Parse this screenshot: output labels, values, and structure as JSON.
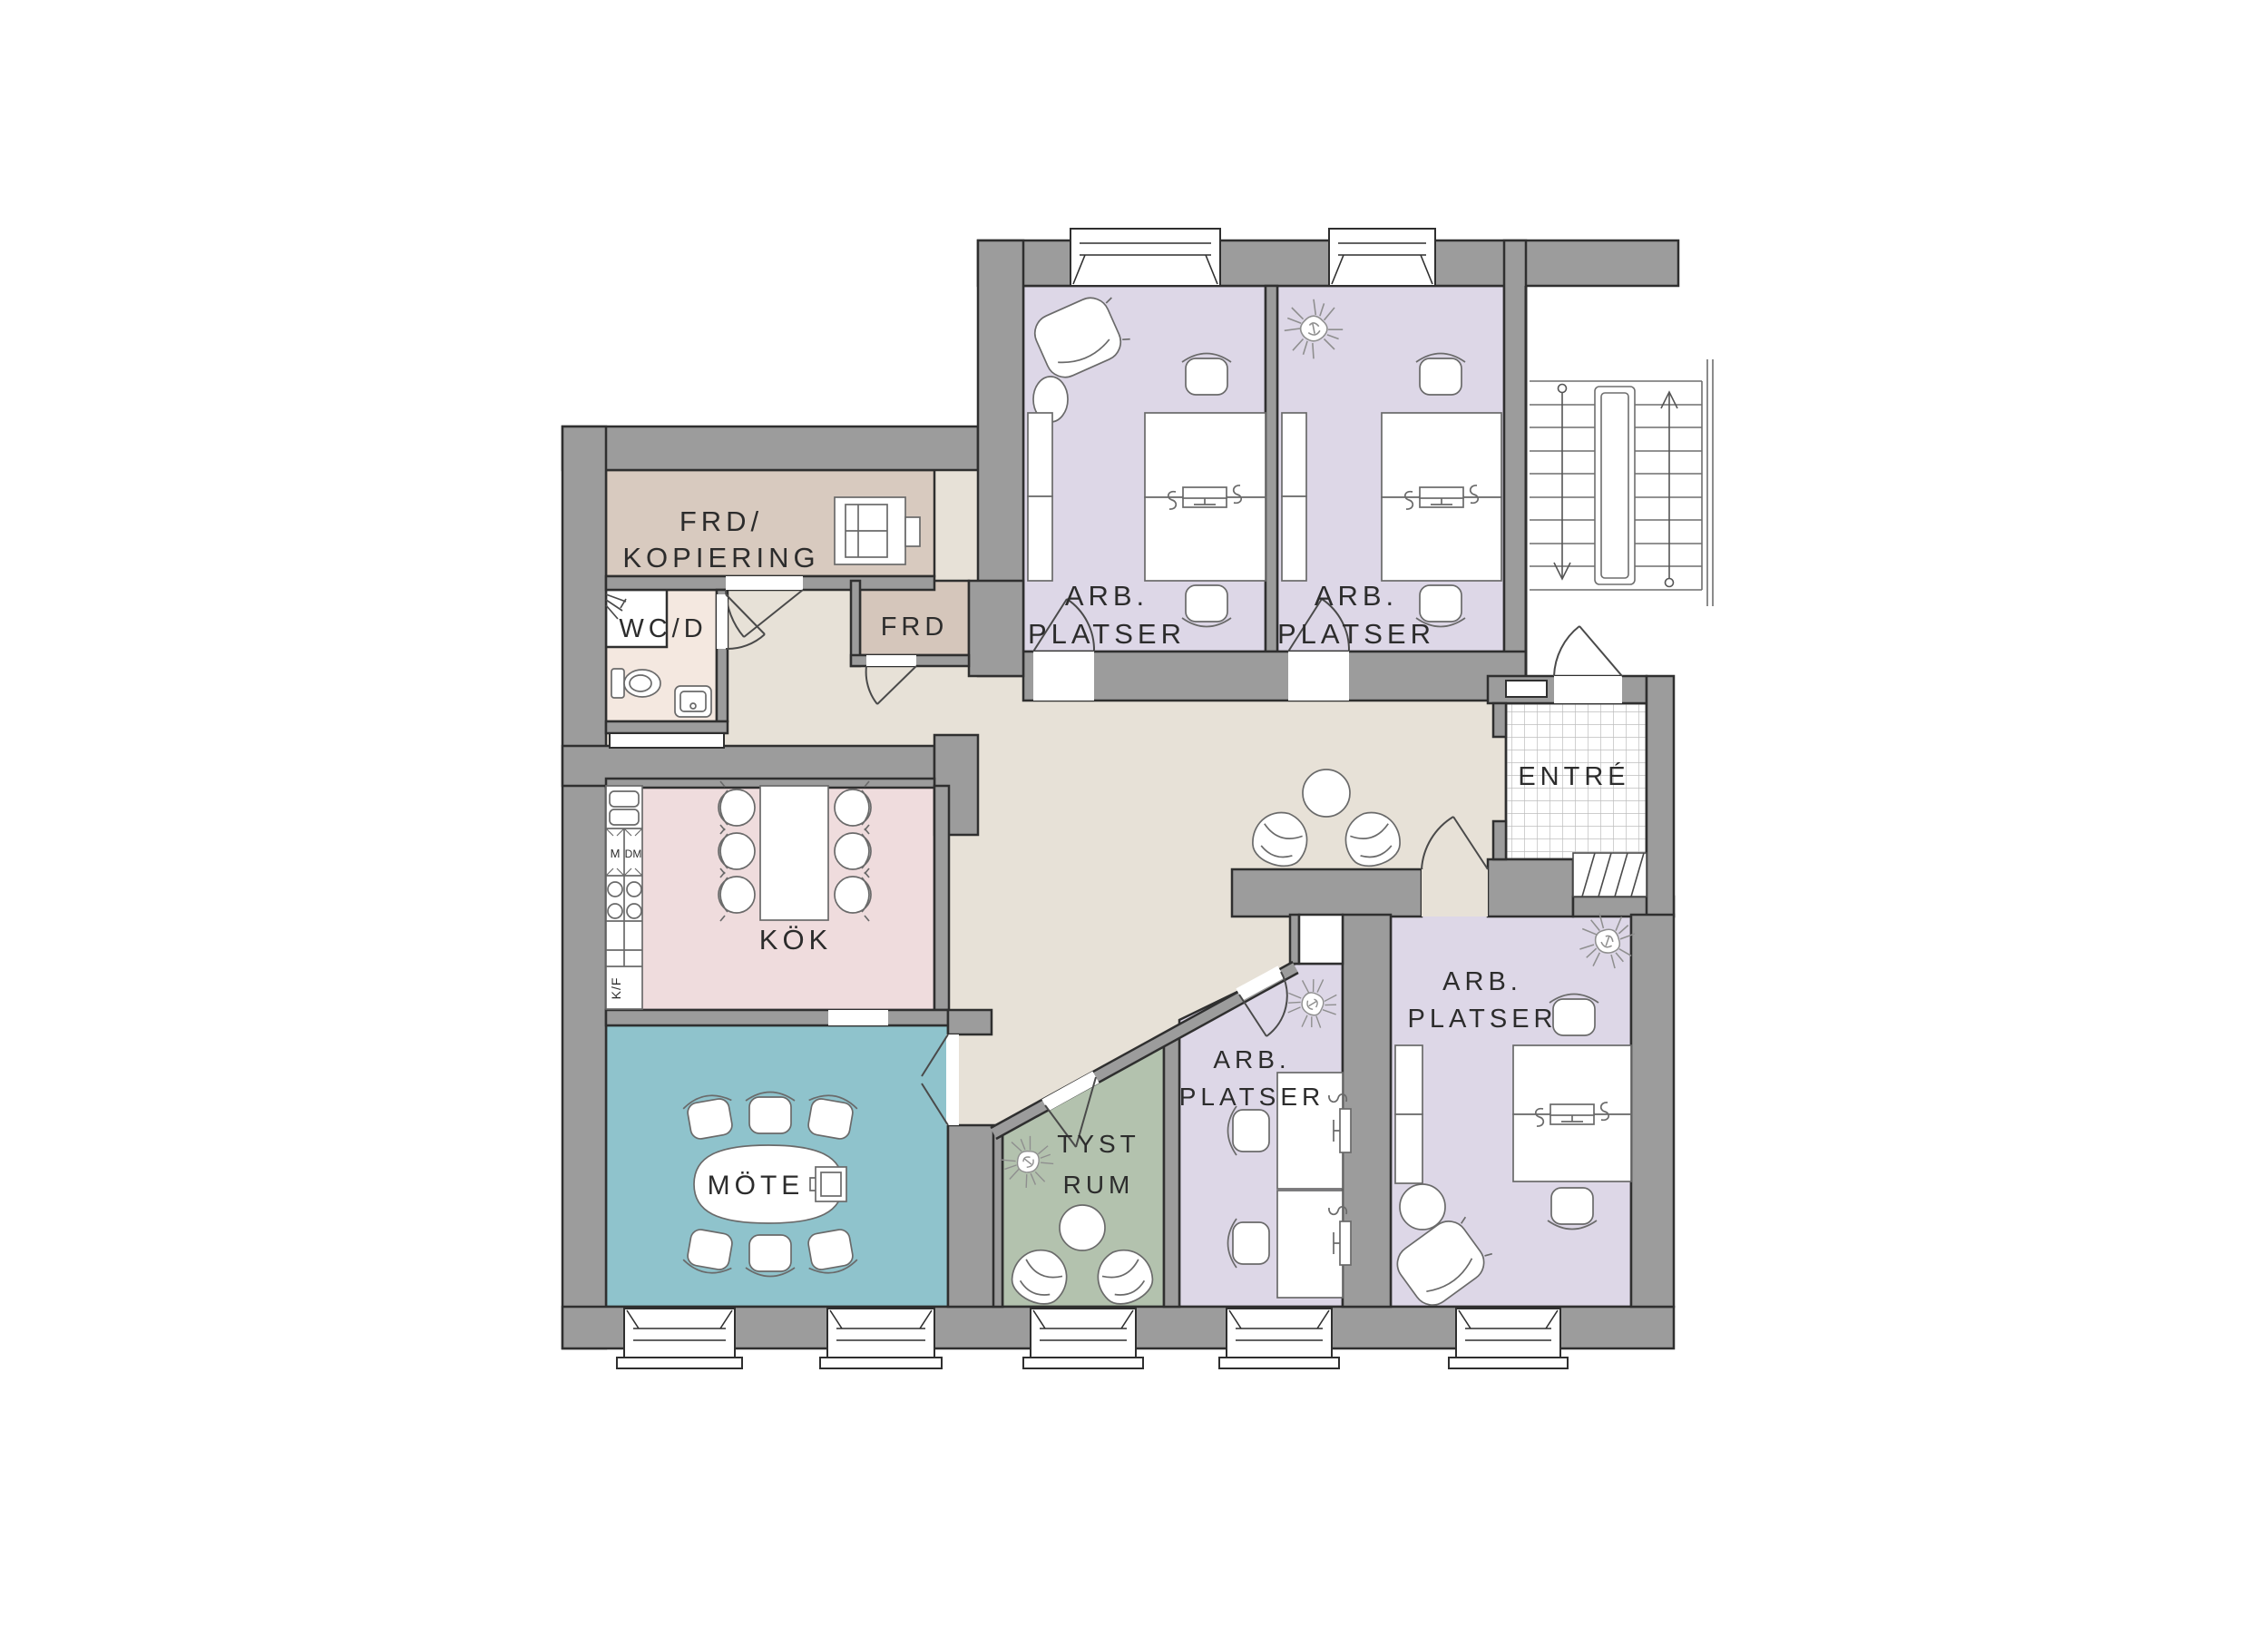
{
  "plan": {
    "type": "floor-plan",
    "rooms": [
      {
        "id": "frd-kopiering",
        "lines": [
          "FRD/",
          "KOPIERING"
        ]
      },
      {
        "id": "wc-d",
        "lines": [
          "WC/D"
        ]
      },
      {
        "id": "frd",
        "lines": [
          "FRD"
        ]
      },
      {
        "id": "arb-platser-nw",
        "lines": [
          "ARB.",
          "PLATSER"
        ]
      },
      {
        "id": "arb-platser-ne",
        "lines": [
          "ARB.",
          "PLATSER"
        ]
      },
      {
        "id": "kok",
        "lines": [
          "KÖK"
        ]
      },
      {
        "id": "mote",
        "lines": [
          "MÖTE"
        ]
      },
      {
        "id": "tyst-rum",
        "lines": [
          "TYST",
          "RUM"
        ]
      },
      {
        "id": "arb-platser-s",
        "lines": [
          "ARB.",
          "PLATSER"
        ]
      },
      {
        "id": "arb-platser-se",
        "lines": [
          "ARB.",
          "PLATSER"
        ]
      },
      {
        "id": "entre",
        "lines": [
          "ENTRÉ"
        ]
      }
    ],
    "appliances": {
      "m": "M",
      "dm": "DM",
      "kf": "K/F"
    },
    "colors": {
      "wall": "#9c9c9c",
      "outline": "#2f2f2f",
      "hall": "#e7e1d7",
      "office": "#ddd7e7",
      "kitchen": "#efdcdd",
      "meeting": "#8fc3cc",
      "quiet": "#b3c2ae",
      "storage": "#d8cabf",
      "storage_small": "#d5c6bb",
      "wc": "#f4e8e0",
      "white": "#ffffff"
    }
  }
}
